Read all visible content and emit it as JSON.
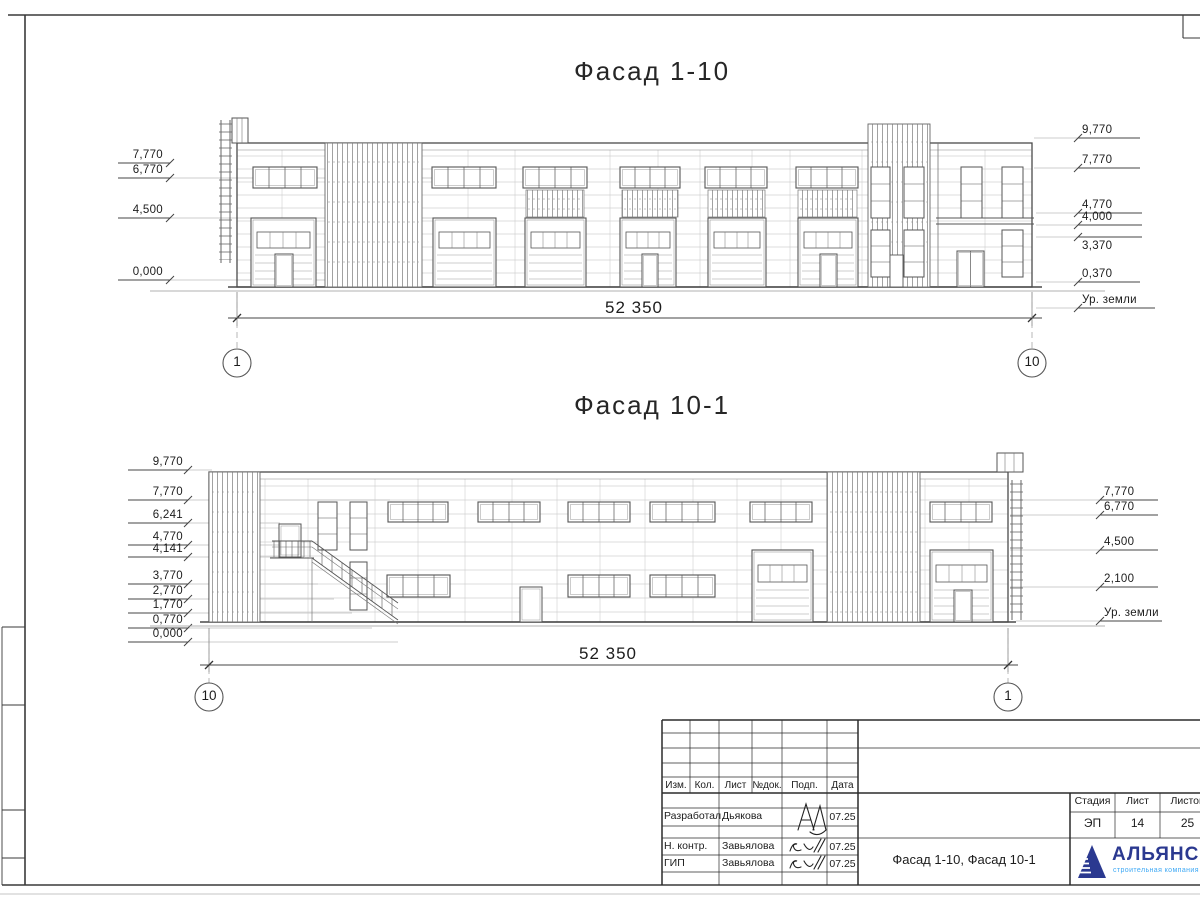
{
  "sheet": {
    "facade1": {
      "title": "Фасад 1-10",
      "left_marks": [
        "7,770",
        "6,770",
        "4,500",
        "0,000"
      ],
      "right_marks": [
        "9,770",
        "7,770",
        "4,770",
        "4,000",
        "3,370",
        "0,370"
      ],
      "ground_label": "Ур. земли",
      "dimension": "52 350",
      "grid_left": "1",
      "grid_right": "10"
    },
    "facade2": {
      "title": "Фасад 10-1",
      "left_marks": [
        "9,770",
        "7,770",
        "6,241",
        "4,770",
        "4,141",
        "3,770",
        "2,770",
        "1,770",
        "0,770",
        "0,000"
      ],
      "right_marks": [
        "7,770",
        "6,770",
        "4,500",
        "2,100"
      ],
      "ground_label": "Ур. земли",
      "dimension": "52 350",
      "grid_left": "10",
      "grid_right": "1"
    }
  },
  "title_block": {
    "col_headers": [
      "Изм.",
      "Кол.",
      "Лист",
      "№док.",
      "Подп.",
      "Дата"
    ],
    "rows": [
      {
        "role": "Разработал",
        "name": "Дьякова",
        "date": "07.25"
      },
      {
        "role": "Н. контр.",
        "name": "Завьялова",
        "date": "07.25"
      },
      {
        "role": "ГИП",
        "name": "Завьялова",
        "date": "07.25"
      }
    ],
    "stage_header": "Стадия",
    "sheet_header": "Лист",
    "sheets_header": "Листов",
    "stage": "ЭП",
    "sheet_no": "14",
    "sheets_total": "25",
    "doc_title": "Фасад 1-10, Фасад 10-1",
    "logo_name": "АЛЬЯНС",
    "logo_subtitle": "строительная компания",
    "logo_color": "#2b3990",
    "logo_accent": "#3fa9f5"
  }
}
